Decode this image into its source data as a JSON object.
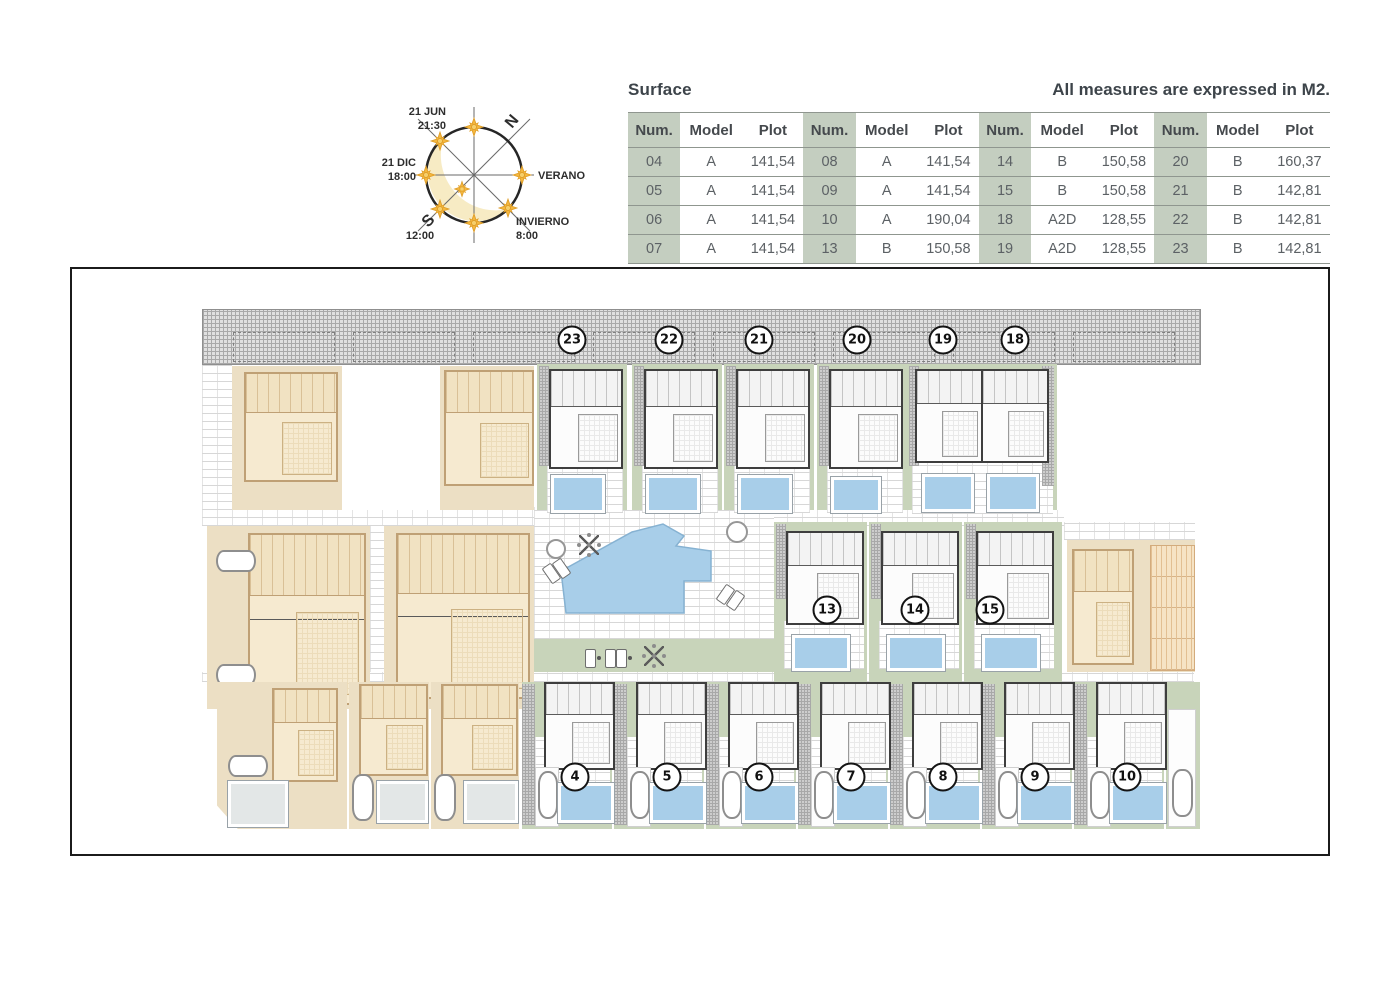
{
  "header": {
    "table_title": "Surface",
    "units_note": "All measures are expressed in M2."
  },
  "surface_table": {
    "columns": [
      "Num.",
      "Model",
      "Plot"
    ],
    "groups": 4,
    "rows": [
      [
        "04",
        "A",
        "141,54",
        "08",
        "A",
        "141,54",
        "14",
        "B",
        "150,58",
        "20",
        "B",
        "160,37"
      ],
      [
        "05",
        "A",
        "141,54",
        "09",
        "A",
        "141,54",
        "15",
        "B",
        "150,58",
        "21",
        "B",
        "142,81"
      ],
      [
        "06",
        "A",
        "141,54",
        "10",
        "A",
        "190,04",
        "18",
        "A2D",
        "128,55",
        "22",
        "B",
        "142,81"
      ],
      [
        "07",
        "A",
        "141,54",
        "13",
        "B",
        "150,58",
        "19",
        "A2D",
        "128,55",
        "23",
        "B",
        "142,81"
      ]
    ]
  },
  "compass": {
    "north_label": "N",
    "south_label": "S",
    "summer_label": "VERANO",
    "winter_label": "INVIERNO",
    "winter_time": "8:00",
    "jun_label": "21 JUN",
    "jun_time": "21:30",
    "dec_label": "21 DIC",
    "dec_time": "18:00",
    "noon_time": "12:00"
  },
  "site_plan": {
    "top_row_units": [
      "23",
      "22",
      "21",
      "20",
      "19",
      "18"
    ],
    "mid_row_units": [
      "13",
      "14",
      "15"
    ],
    "bottom_row_units": [
      "4",
      "5",
      "6",
      "7",
      "8",
      "9",
      "10"
    ]
  },
  "colors": {
    "table_shade": "#c4cec0",
    "plot_green": "#c8d4ba",
    "plot_tan": "#ecdfc4",
    "pool_blue": "#a8cee9",
    "road_hatch_gray": "#e0e0e0",
    "sun_gold": "#f4b73e",
    "text_dark": "#3d444a"
  }
}
